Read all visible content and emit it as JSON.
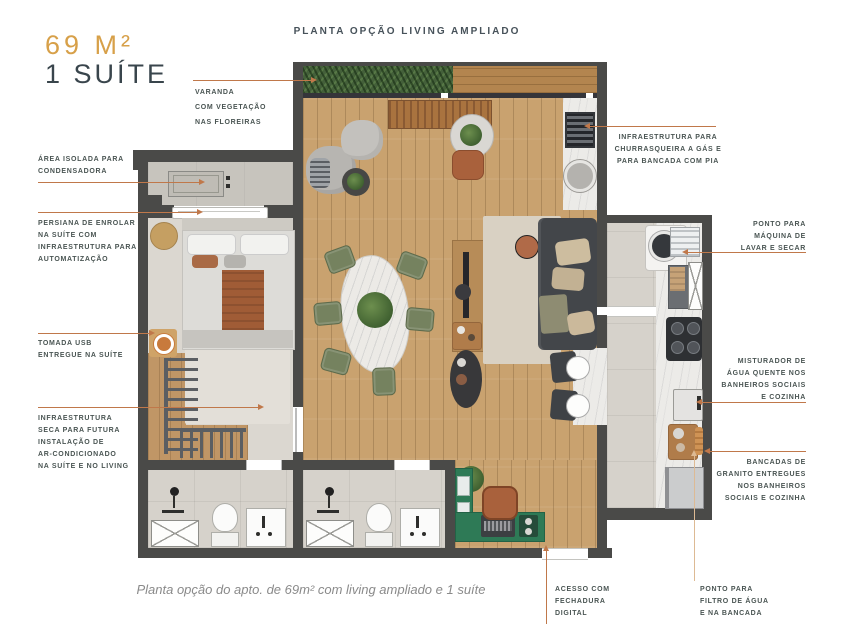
{
  "header": {
    "area": "69 M²",
    "suite": "1 SUÍTE",
    "plan_title": "PLANTA OPÇÃO LIVING AMPLIADO"
  },
  "caption": "Planta opção do apto. de 69m² com living ampliado e 1 suíte",
  "colors": {
    "accent": "#C0784A",
    "accent_soft": "#DDBA94",
    "gold": "#D7A049",
    "ink": "#4A5553",
    "heading": "#39454C",
    "title": "#47525A",
    "cap": "#8A8A8A",
    "wall": "#4A4A48"
  },
  "callouts": {
    "varanda": {
      "lines": [
        "VARANDA",
        "COM VEGETAÇÃO",
        "NAS FLOREIRAS"
      ]
    },
    "condensadora": {
      "lines": [
        "ÁREA ISOLADA PARA",
        "CONDENSADORA"
      ]
    },
    "persiana": {
      "lines": [
        "PERSIANA DE ENROLAR",
        "NA SUÍTE COM",
        "INFRAESTRUTURA PARA",
        "AUTOMATIZAÇÃO"
      ]
    },
    "tomada_usb": {
      "lines": [
        "TOMADA USB",
        "ENTREGUE NA SUÍTE"
      ]
    },
    "infra_seca": {
      "lines": [
        "INFRAESTRUTURA",
        "SECA PARA FUTURA",
        "INSTALAÇÃO DE",
        "AR-CONDICIONADO",
        "NA SUÍTE E NO LIVING"
      ]
    },
    "churrasqueira": {
      "lines": [
        "INFRAESTRUTURA PARA",
        "CHURRASQUEIRA A GÁS E",
        "PARA BANCADA COM PIA"
      ]
    },
    "lavar_secar": {
      "lines": [
        "PONTO PARA",
        "MÁQUINA DE",
        "LAVAR E SECAR"
      ]
    },
    "misturador": {
      "lines": [
        "MISTURADOR DE",
        "ÁGUA QUENTE NOS",
        "BANHEIROS SOCIAIS",
        "E COZINHA"
      ]
    },
    "bancadas": {
      "lines": [
        "BANCADAS DE",
        "GRANITO ENTREGUES",
        "NOS BANHEIROS",
        "SOCIAIS E COZINHA"
      ]
    },
    "fechadura": {
      "lines": [
        "ACESSO COM",
        "FECHADURA",
        "DIGITAL"
      ]
    },
    "filtro": {
      "lines": [
        "PONTO PARA",
        "FILTRO DE ÁGUA",
        "E NA BANCADA"
      ]
    }
  }
}
